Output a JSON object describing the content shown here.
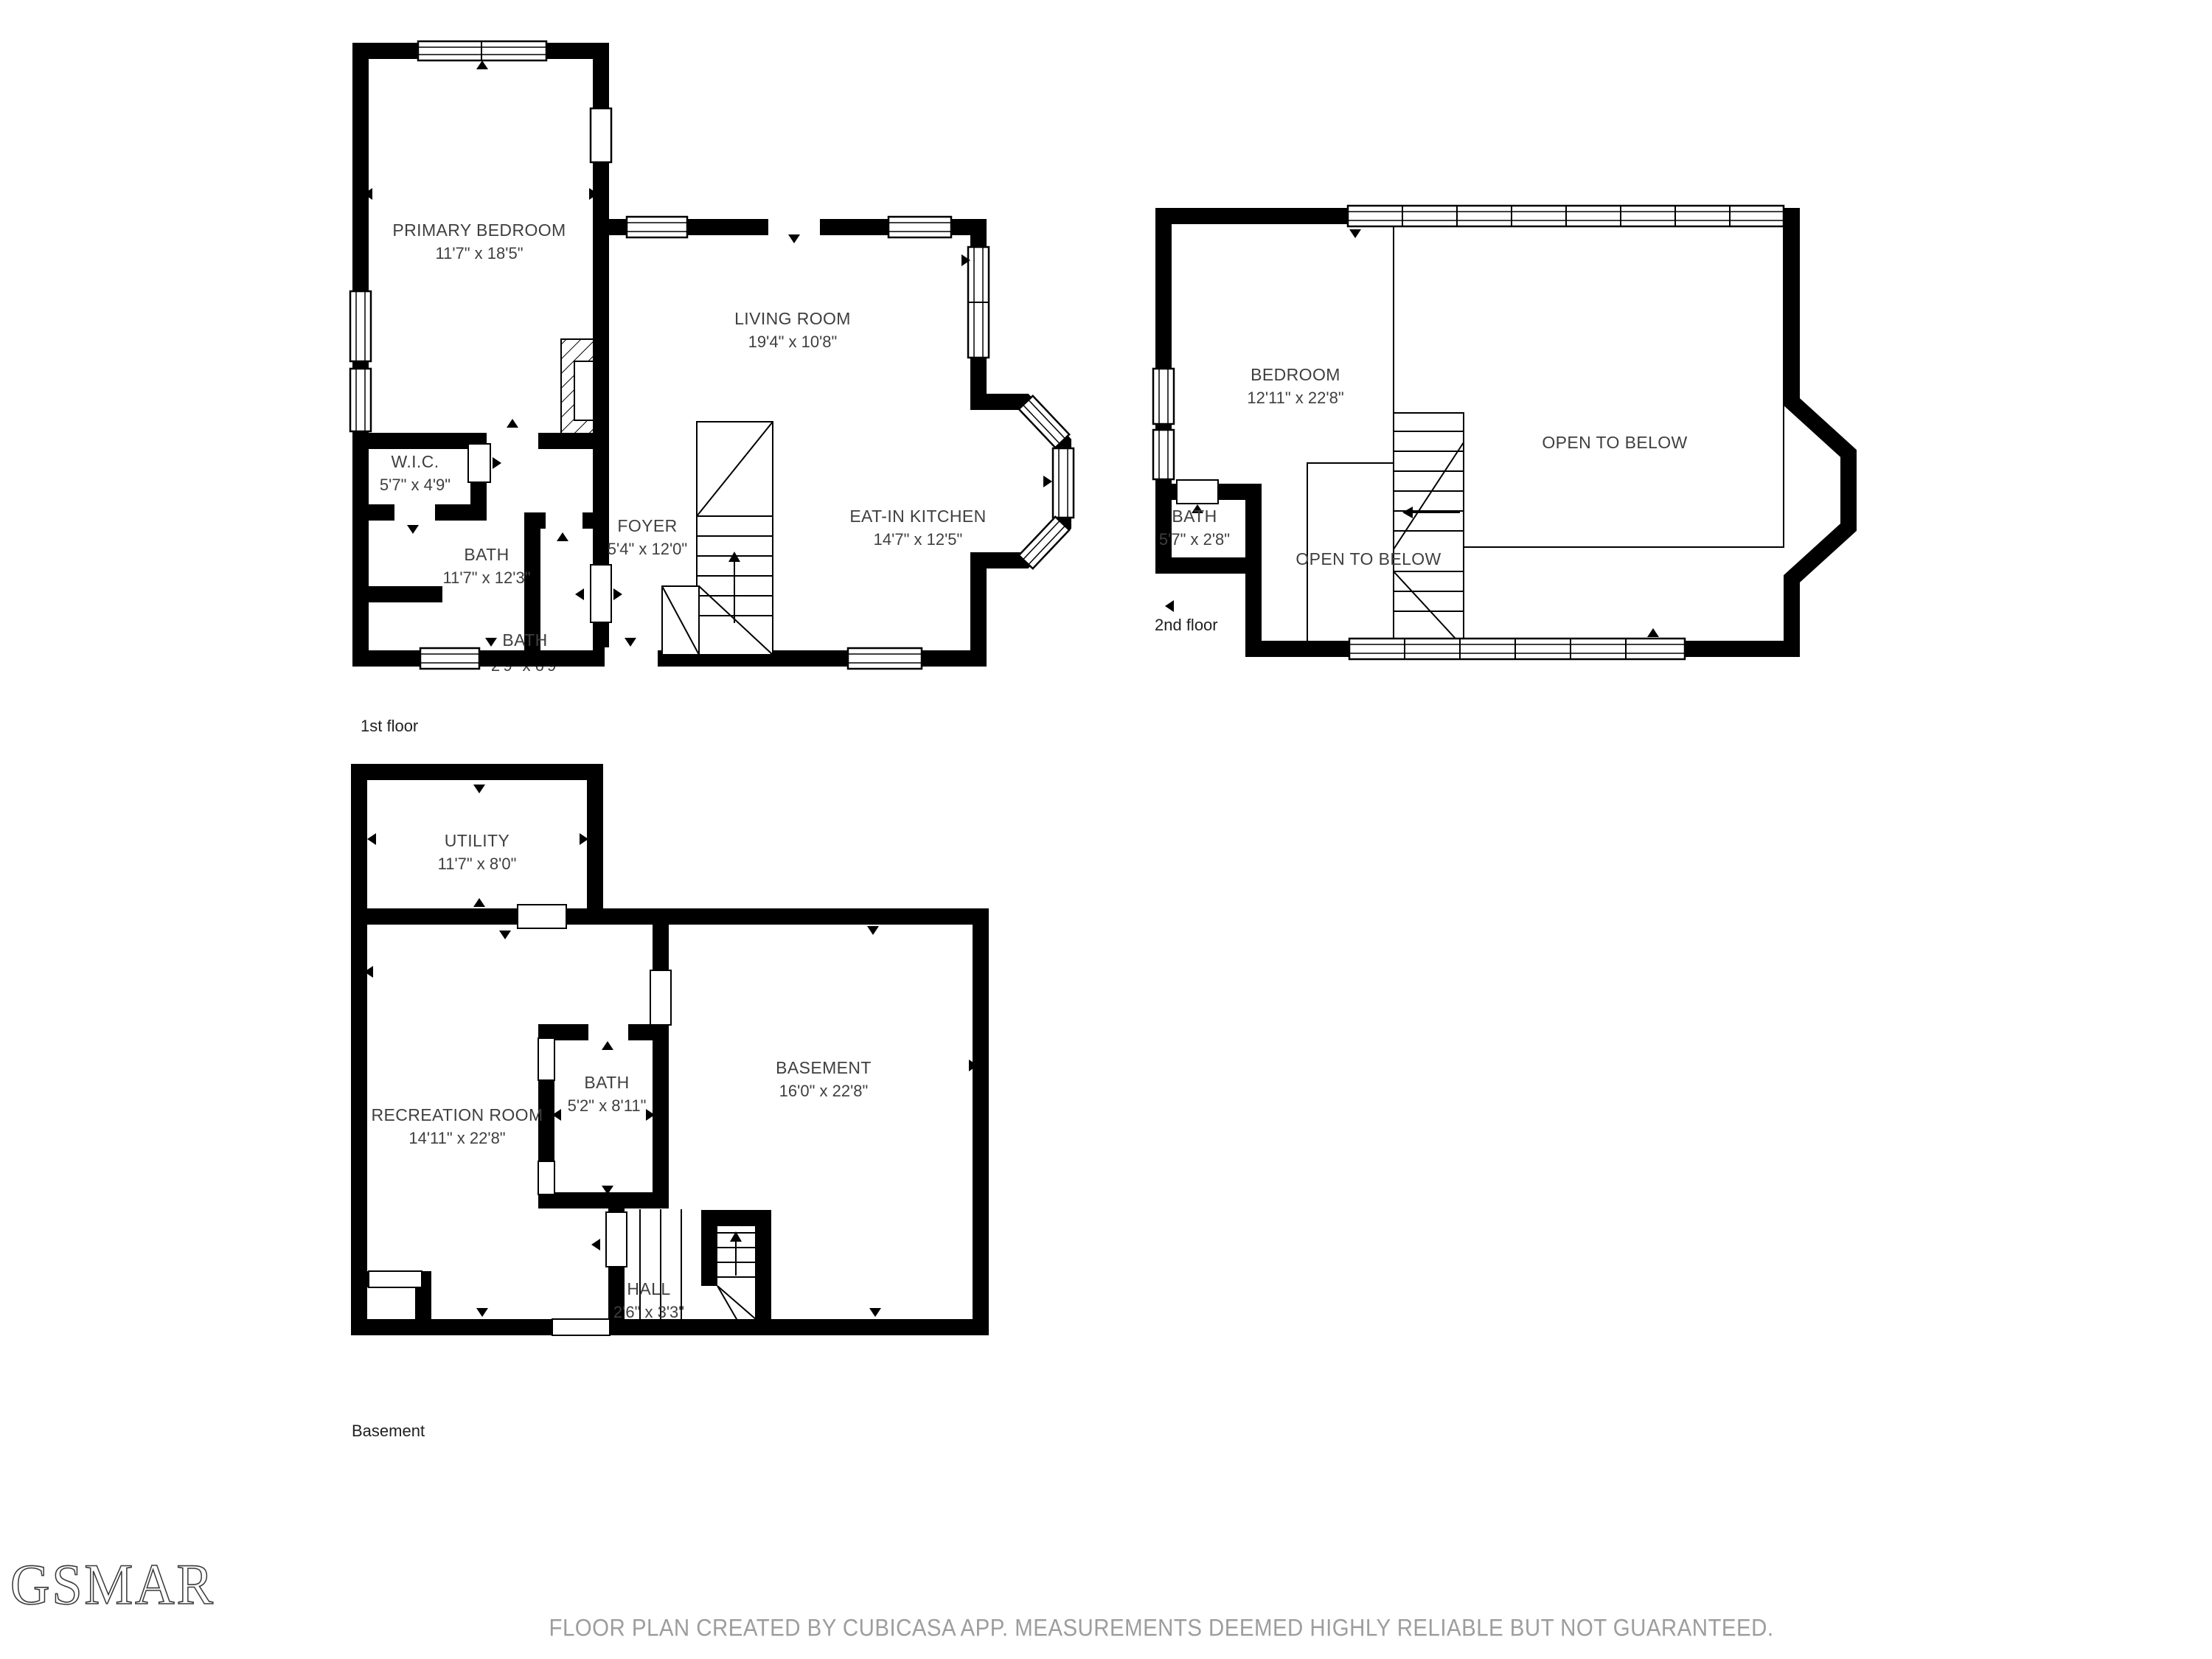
{
  "floors": [
    {
      "label": "1st floor",
      "rooms": [
        {
          "name": "PRIMARY BEDROOM",
          "dims": "11'7\" x 18'5\""
        },
        {
          "name": "LIVING ROOM",
          "dims": "19'4\" x 10'8\""
        },
        {
          "name": "W.I.C.",
          "dims": "5'7\" x 4'9\""
        },
        {
          "name": "BATH",
          "dims": "11'7\" x 12'3\""
        },
        {
          "name": "FOYER",
          "dims": "5'4\" x 12'0\""
        },
        {
          "name": "EAT-IN KITCHEN",
          "dims": "14'7\" x 12'5\""
        },
        {
          "name": "BATH",
          "dims": "2'9\" x 6'9\""
        }
      ]
    },
    {
      "label": "2nd floor",
      "rooms": [
        {
          "name": "BEDROOM",
          "dims": "12'11\" x 22'8\""
        },
        {
          "name": "BATH",
          "dims": "5'7\" x 2'8\""
        },
        {
          "name": "OPEN TO BELOW",
          "dims": ""
        },
        {
          "name": "OPEN TO BELOW",
          "dims": ""
        }
      ]
    },
    {
      "label": "Basement",
      "rooms": [
        {
          "name": "UTILITY",
          "dims": "11'7\" x 8'0\""
        },
        {
          "name": "RECREATION ROOM",
          "dims": "14'11\" x 22'8\""
        },
        {
          "name": "BATH",
          "dims": "5'2\" x 8'11\""
        },
        {
          "name": "BASEMENT",
          "dims": "16'0\" x 22'8\""
        },
        {
          "name": "HALL",
          "dims": "2'6\" x 3'3\""
        }
      ]
    }
  ],
  "branding": {
    "logo_text": "GSMAR"
  },
  "footer": {
    "disclaimer": "FLOOR PLAN CREATED BY CUBICASA APP. MEASUREMENTS DEEMED HIGHLY RELIABLE BUT NOT GUARANTEED."
  },
  "colors": {
    "wall": "#000000",
    "room_label": "#3f3f3f",
    "floor_label": "#1f1f1f",
    "footer_text": "#9d9d9d",
    "background": "#ffffff"
  }
}
